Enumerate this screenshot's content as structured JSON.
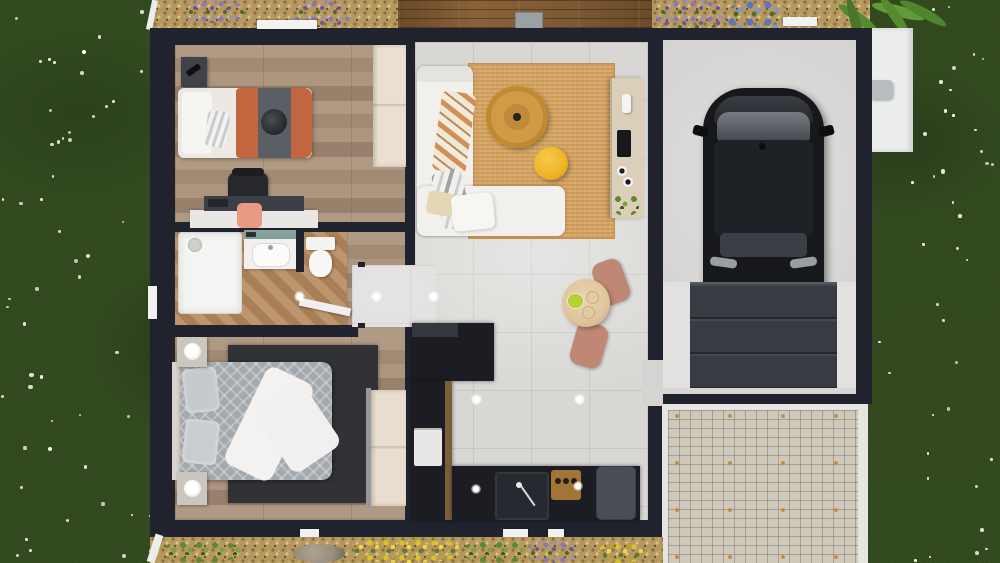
{
  "scene": {
    "description": "Top-down 3D architectural rendering of a single-storey house with adjoining garage, lawn, gravel flower beds, wooden deck and cobblestone driveway",
    "view": "top-down orthographic 3D render",
    "rooms": [
      {
        "name": "bedroom-1",
        "floor": "light oak plank",
        "furniture": [
          "dark bedside table with phone",
          "single bed with white, orange and grey bedding",
          "round dark cushion",
          "desk with coral chair",
          "dark office chair",
          "light wood wardrobe"
        ]
      },
      {
        "name": "bathroom",
        "floor": "herringbone parquet",
        "furniture": [
          "walk-in shower tray",
          "vanity with washbasin and teal backsplash",
          "toilet",
          "open white door"
        ]
      },
      {
        "name": "hallway",
        "floor": "grey tile and oak",
        "furniture": []
      },
      {
        "name": "bedroom-2",
        "floor": "light oak plank",
        "furniture": [
          "double bed with grey patterned duvet and white throw",
          "two bedside tables with round lamps",
          "dark grey rug",
          "light wood wardrobe"
        ]
      },
      {
        "name": "living-room",
        "floor": "light grey tile",
        "furniture": [
          "white corner sofa with striped throws",
          "round rattan coffee table",
          "jute rug",
          "yellow pouf",
          "white ottoman cushions",
          "wooden sideboard with tv, vase and plant"
        ]
      },
      {
        "name": "dining-area",
        "floor": "light grey tile",
        "furniture": [
          "round wooden table",
          "two terracotta chairs",
          "bowl of limes",
          "plates"
        ]
      },
      {
        "name": "kitchen",
        "floor": "light grey tile",
        "furniture": [
          "black L-shaped counter",
          "extractor block",
          "built-in white oven",
          "sink with faucet",
          "wooden board with jars",
          "dark grey fridge"
        ]
      },
      {
        "name": "garage",
        "floor": "concrete",
        "furniture": [
          "black car",
          "grey sectional garage door"
        ]
      }
    ],
    "exterior": [
      "lawn with scattered white flowers",
      "gravel beds with lavender and blue hydrangea",
      "wooden deck terrace with grey doormat",
      "palm plant",
      "white garden bench with grey cushion",
      "cobblestone driveway with white borders",
      "rock",
      "yellow and green shrubs",
      "white window sills"
    ],
    "colors": {
      "grass": "#344b20",
      "gravel": "#b5985f",
      "deck": "#7b5833",
      "wall": "#20232d",
      "wood_floor": "#a78f79",
      "herringbone": "#b08a62",
      "tile": "#d8d7d4",
      "tile_line": "#c7c6c3",
      "garage_floor": "#d2d1cf",
      "cobblestone": "#cfc9bc",
      "driveway_border": "#e6e5e2",
      "sofa": "#f1f0ed",
      "rug_jute": "#d8a766",
      "rug_dark": "#303236",
      "rattan": "#d09a47",
      "pouf_yellow": "#eeb426",
      "bedding_orange": "#c2663f",
      "bedding_grey_band": "#5a5f66",
      "duvet_grey": "#a4a9ae",
      "counter_black": "#1b1d22",
      "counter_wood_edge": "#7d5e3c",
      "fridge": "#494d55",
      "chair_terracotta": "#c08874",
      "table_wood": "#e0c49d",
      "sideboard": "#dbcfba",
      "car": "#17181b",
      "car_roof": "#1e2126",
      "car_glass": "#6f7378",
      "garage_door": "#383b42",
      "teal": "#85a39d",
      "coral": "#e89a82",
      "lavender": "#8a76bd",
      "hydrangea": "#5a74c8",
      "flower_yellow": "#d8c22a",
      "foliage": "#4a6b2e",
      "rock": "#968e7c",
      "bench": "#eceeed",
      "cushion_grey": "#b9bdc1",
      "mat_grey": "#9aa0a3",
      "white": "#eceeec",
      "lime_bowl": "#b7d22f"
    }
  }
}
